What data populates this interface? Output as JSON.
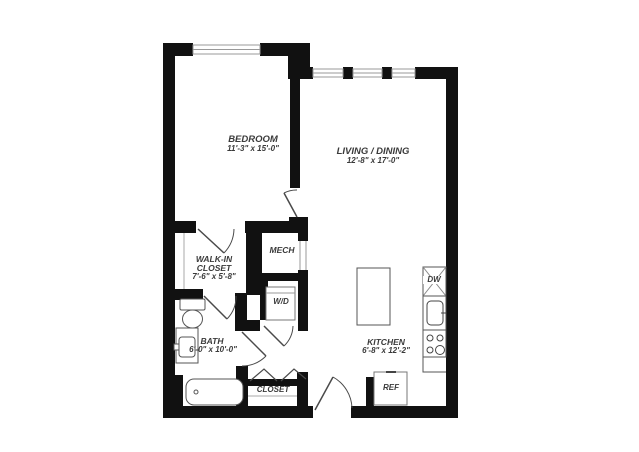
{
  "plan": {
    "rooms": {
      "bedroom": {
        "name": "BEDROOM",
        "dims": "11'-3\" x 15'-0\""
      },
      "living": {
        "name": "LIVING / DINING",
        "dims": "12'-8\" x 17'-0\""
      },
      "walkin": {
        "name_line1": "WALK-IN",
        "name_line2": "CLOSET",
        "dims": "7'-6\" x 5'-8\""
      },
      "bath": {
        "name": "BATH",
        "dims": "6'-0\" x 10'-0\""
      },
      "kitchen": {
        "name": "KITCHEN",
        "dims": "6'-8\" x 12'-2\""
      },
      "mech": {
        "name": "MECH"
      },
      "wd": {
        "name": "W/D"
      },
      "closet": {
        "name": "CLOSET"
      },
      "ref": {
        "name": "REF"
      },
      "dw": {
        "name": "DW"
      }
    },
    "colors": {
      "wall": "#111111",
      "fixture_line": "#555555",
      "door_line": "#4a4a4a",
      "window_line": "#999999",
      "text": "#3a3a3a"
    }
  }
}
